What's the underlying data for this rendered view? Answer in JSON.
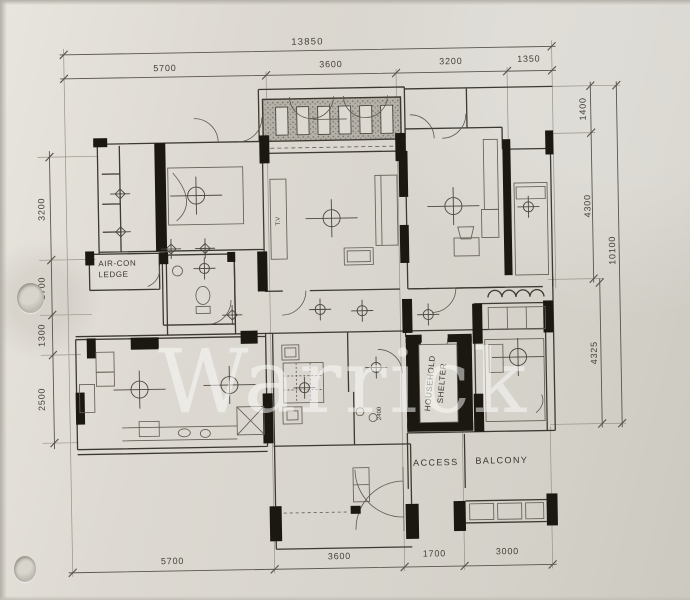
{
  "document": {
    "kind": "scanned-floor-plan",
    "watermark_text": "Warrick"
  },
  "colors": {
    "paper": "#d8d5ce",
    "ink": "#3c3933",
    "wall_fill": "#1b1812",
    "watermark": "rgba(252,252,250,0.52)"
  },
  "dimensions": {
    "top_overall": "13850",
    "top_segments": [
      "5700",
      "3600",
      "3200",
      "1350"
    ],
    "bottom_segments": [
      "5700",
      "3600",
      "1700",
      "3000"
    ],
    "left_segments": [
      "3200",
      "1700",
      "1300",
      "2500"
    ],
    "right_segments": [
      "1400",
      "4300",
      "4325"
    ],
    "right_overall": "10100"
  },
  "labels": {
    "aircon_line1": "AIR-CON",
    "aircon_line2": "LEDGE",
    "shelter_line1": "HOUSEHOLD",
    "shelter_line2": "SHELTER",
    "access": "ACCESS",
    "balcony": "BALCONY",
    "tv": "T.V",
    "annotation_2400": "2400"
  }
}
